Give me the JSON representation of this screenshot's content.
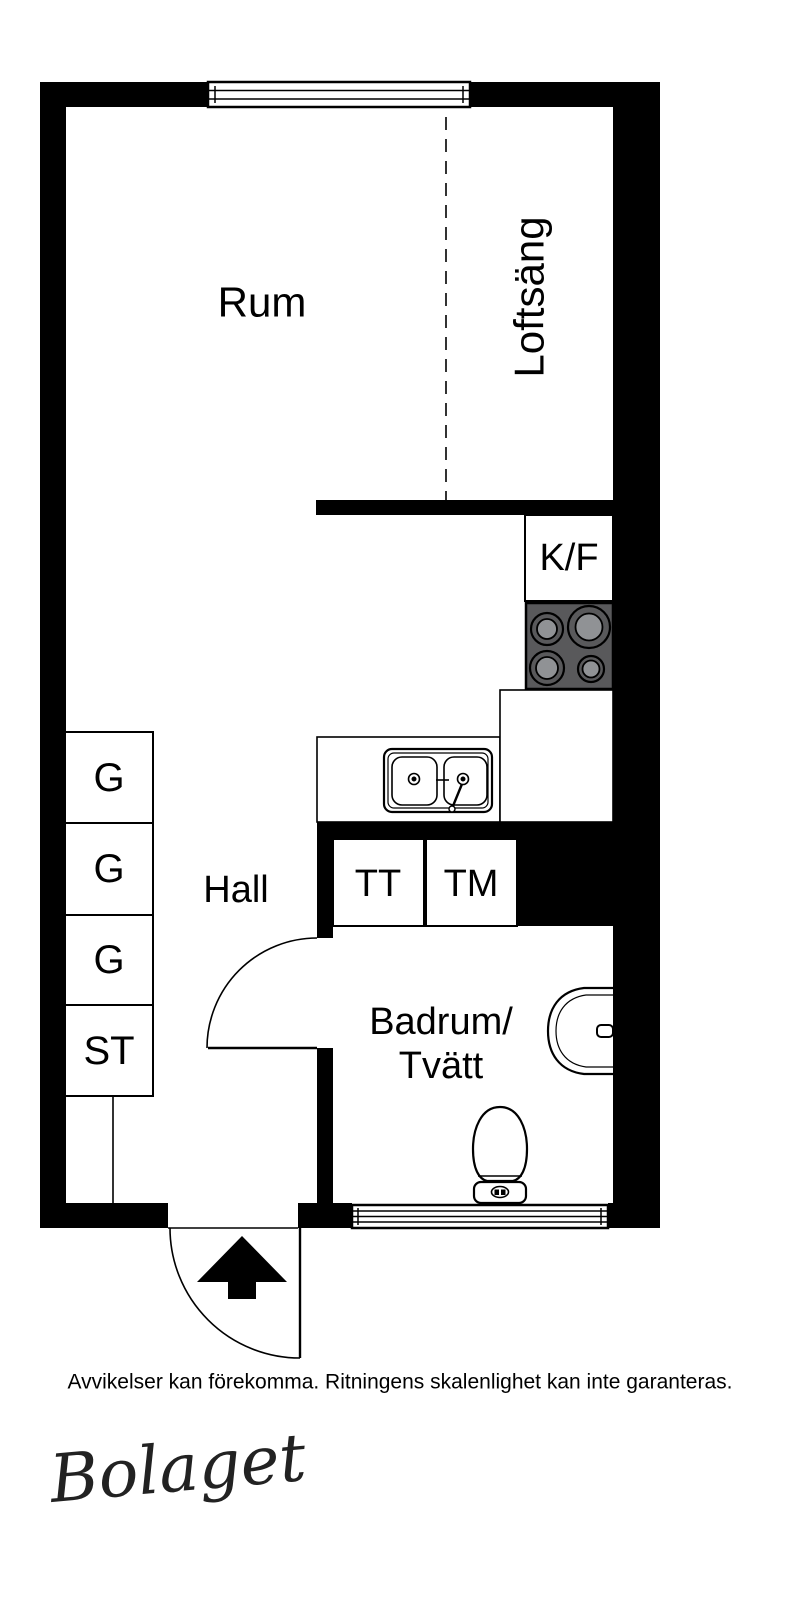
{
  "floorplan": {
    "rooms": {
      "room_label": "Rum",
      "loft_label": "Loftsäng",
      "hall_label": "Hall",
      "bathroom_label_line1": "Badrum/",
      "bathroom_label_line2": "Tvätt"
    },
    "fixtures": {
      "fridge_freezer_label": "K/F",
      "dryer_label": "TT",
      "washer_label": "TM",
      "wardrobe1_label": "G",
      "wardrobe2_label": "G",
      "wardrobe3_label": "G",
      "cleaning_closet_label": "ST"
    },
    "colors": {
      "wall": "#000000",
      "background": "#ffffff",
      "stove": "#59595b",
      "burner_center": "#909295",
      "line": "#000000"
    }
  },
  "footer": {
    "disclaimer": "Avvikelser kan förekomma. Ritningens skalenlighet kan inte garanteras.",
    "logo_text": "Bolaget"
  }
}
